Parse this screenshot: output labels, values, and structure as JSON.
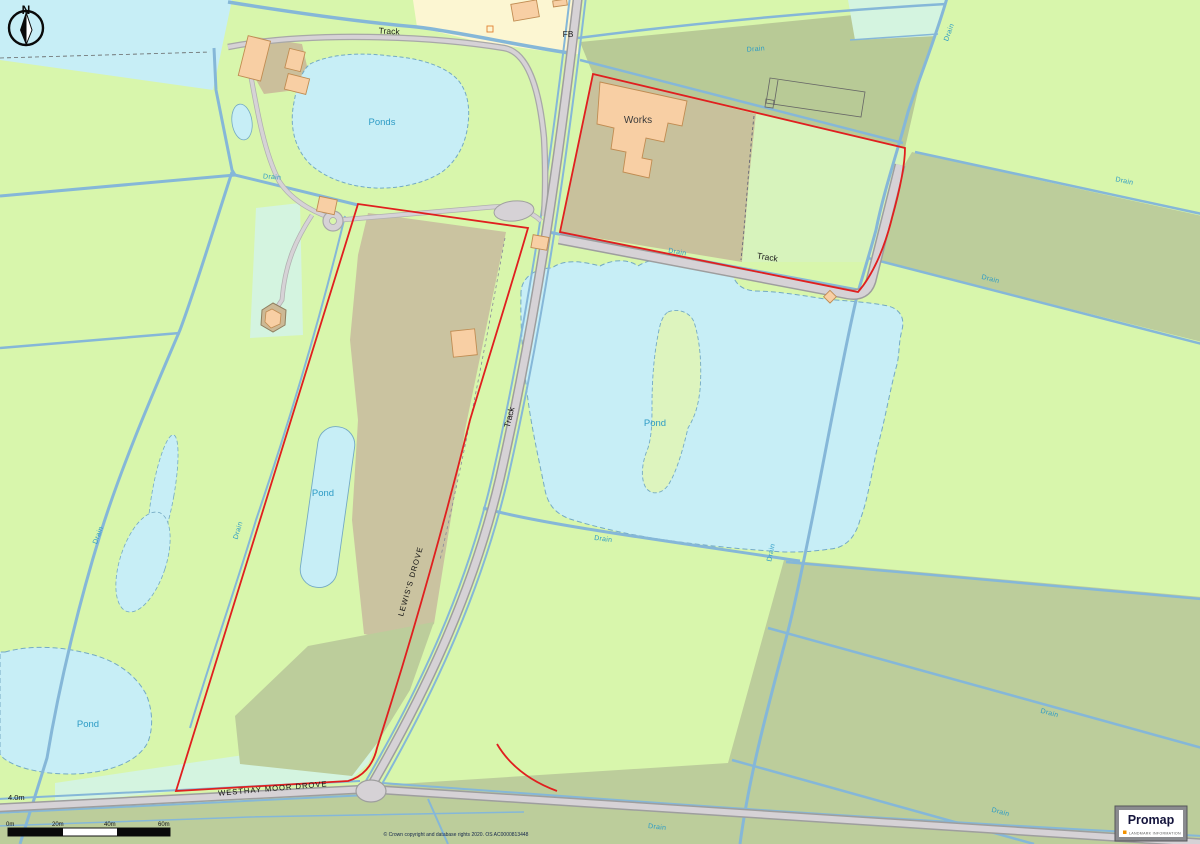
{
  "map": {
    "compass_letter": "N",
    "height_annotation": "4.0m",
    "scale_bar": {
      "labels": [
        "0m",
        "20m",
        "40m",
        "60m"
      ]
    },
    "copyright": "© Crown copyright and database rights 2020. OS AC0000813448",
    "logo": {
      "name": "Promap",
      "tagline": "LANDMARK INFORMATION"
    },
    "colors": {
      "field_green": "#d8f6ac",
      "field_olive": "#bccd9b",
      "field_mint": "#d4f4e0",
      "field_yellow": "#fcf6d2",
      "disturbed_tan": "#c8c19c",
      "water_cyan": "#c7eef6",
      "building_peach": "#f8cfa4",
      "road_gray": "#d6d2d6",
      "drain_blue": "#85b7d8",
      "boundary_red": "#e01f1f",
      "water_text": "#2d9bc5"
    },
    "labels": [
      {
        "text": "Ponds",
        "x": 382,
        "y": 125,
        "rot": 0,
        "cls": "water-lg"
      },
      {
        "text": "Pond",
        "x": 655,
        "y": 426,
        "rot": 0,
        "cls": "water-lg"
      },
      {
        "text": "Pond",
        "x": 323,
        "y": 496,
        "rot": 0,
        "cls": "water-lg"
      },
      {
        "text": "Pond",
        "x": 88,
        "y": 727,
        "rot": 0,
        "cls": "water-lg"
      },
      {
        "text": "Drain",
        "x": 272,
        "y": 179,
        "rot": 4,
        "cls": "water-sm"
      },
      {
        "text": "Drain",
        "x": 100,
        "y": 536,
        "rot": -69,
        "cls": "water-sm"
      },
      {
        "text": "Drain",
        "x": 240,
        "y": 531,
        "rot": -73,
        "cls": "water-sm"
      },
      {
        "text": "Drain",
        "x": 756,
        "y": 51,
        "rot": -5,
        "cls": "water-sm"
      },
      {
        "text": "Drain",
        "x": 951,
        "y": 33,
        "rot": -70,
        "cls": "water-sm"
      },
      {
        "text": "Drain",
        "x": 1124,
        "y": 183,
        "rot": 12,
        "cls": "water-sm"
      },
      {
        "text": "Drain",
        "x": 990,
        "y": 281,
        "rot": 14,
        "cls": "water-sm"
      },
      {
        "text": "Drain",
        "x": 677,
        "y": 254,
        "rot": 10,
        "cls": "water-sm"
      },
      {
        "text": "Drain",
        "x": 603,
        "y": 541,
        "rot": 7,
        "cls": "water-sm"
      },
      {
        "text": "Drain",
        "x": 773,
        "y": 553,
        "rot": -78,
        "cls": "water-sm"
      },
      {
        "text": "Drain",
        "x": 1049,
        "y": 715,
        "rot": 15,
        "cls": "water-sm"
      },
      {
        "text": "Drain",
        "x": 1000,
        "y": 814,
        "rot": 15,
        "cls": "water-sm"
      },
      {
        "text": "Drain",
        "x": 657,
        "y": 829,
        "rot": 6,
        "cls": "water-sm"
      },
      {
        "text": "Track",
        "x": 389,
        "y": 34,
        "rot": 3,
        "cls": "black"
      },
      {
        "text": "Track",
        "x": 767,
        "y": 260,
        "rot": 9,
        "cls": "black"
      },
      {
        "text": "Track",
        "x": 512,
        "y": 418,
        "rot": -76,
        "cls": "black"
      },
      {
        "text": "FB",
        "x": 568,
        "y": 37,
        "rot": 0,
        "cls": "black"
      },
      {
        "text": "Works",
        "x": 638,
        "y": 123,
        "rot": 0,
        "cls": "works"
      },
      {
        "text": "LEWIS'S DROVE",
        "x": 413,
        "y": 582,
        "rot": -74,
        "cls": "road"
      },
      {
        "text": "WESTHAY MOOR DROVE",
        "x": 273,
        "y": 791,
        "rot": -5,
        "cls": "road"
      }
    ]
  }
}
